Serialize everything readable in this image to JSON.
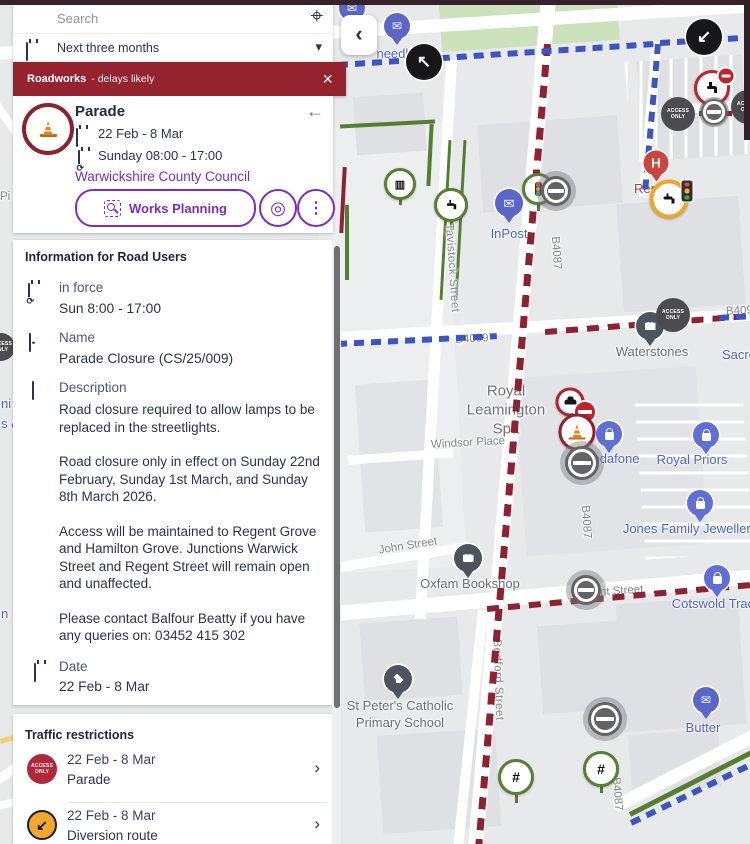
{
  "topbar": {
    "search_placeholder": "Search",
    "date_filter": "Next three months"
  },
  "banner": {
    "title": "Roadworks",
    "subtitle": "- delays likely"
  },
  "incident": {
    "title": "Parade",
    "date_range": "22 Feb - 8 Mar",
    "schedule": "Sunday 08:00 - 17:00",
    "authority": "Warwickshire County Council",
    "works_planning_label": "Works Planning"
  },
  "info": {
    "heading": "Information for Road Users",
    "in_force_label": "in force",
    "in_force_value": "Sun 8:00 - 17:00",
    "name_label": "Name",
    "name_value": "Parade Closure (CS/25/009)",
    "description_label": "Description",
    "description_paragraphs": [
      "Road closure required to allow lamps to be replaced in the streetlights.",
      "Road closure only in effect on Sunday 22nd February, Sunday 1st March, and Sunday 8th March 2026.",
      "Access will be maintained to Regent Grove and Hamilton Grove. Junctions Warwick Street and Regent Street will remain open and unaffected.",
      "Please contact Balfour Beatty if you have any queries on: 03452 415 302"
    ],
    "date_label": "Date",
    "date_value": "22 Feb - 8 Mar"
  },
  "restrictions": {
    "heading": "Traffic restrictions",
    "items": [
      {
        "date": "22 Feb - 8 Mar",
        "name": "Parade"
      },
      {
        "date": "22 Feb - 8 Mar",
        "name": "Diversion route"
      }
    ]
  },
  "map": {
    "place": "Royal\nLeamington\nSpa",
    "access_only": "ACCESS\nONLY",
    "roads": {
      "tavistock": "Tavistock Street",
      "b4087": "B4087",
      "b4099": "B4099",
      "b409": "B409",
      "regent": "Regent Street",
      "windsor": "Windsor Place",
      "john": "John Street",
      "bedford": "Bedford Street"
    },
    "pois": {
      "needle": "needle",
      "inpost": "InPost",
      "waterstones": "Waterstones",
      "sacred": "Sacred",
      "royal_priors": "Royal Priors",
      "jones": "Jones Family Jewellers",
      "vodafone": "Vodafone",
      "oxfam": "Oxfam Bookshop",
      "cotswold": "Cotswold Trading",
      "st_peters": "St Peter's Catholic\nPrimary School",
      "butter": "Butter",
      "ren": "Ren",
      "hospital": "H"
    },
    "fragments": {
      "f1": "Pi",
      "f2": "ni",
      "f3": "s &",
      "f4": "n"
    }
  },
  "icons": {
    "locate": "⌖",
    "caret_down": "▾",
    "close": "×",
    "back": "←",
    "chevron_right": "›",
    "collapse_left": "‹",
    "kebab": "⋮",
    "target": "◎",
    "mail": "✉",
    "columns": "▥",
    "hash": "#",
    "arrow_nw": "↖",
    "arrow_sw": "↙"
  },
  "colors": {
    "banner": "#95222F",
    "accent_purple": "#7A2EC0",
    "closure_red": "#8E2230",
    "diversion_blue": "#3B55C4",
    "restriction_red": "#B3273A",
    "diversion_badge": "#F0A82E"
  }
}
